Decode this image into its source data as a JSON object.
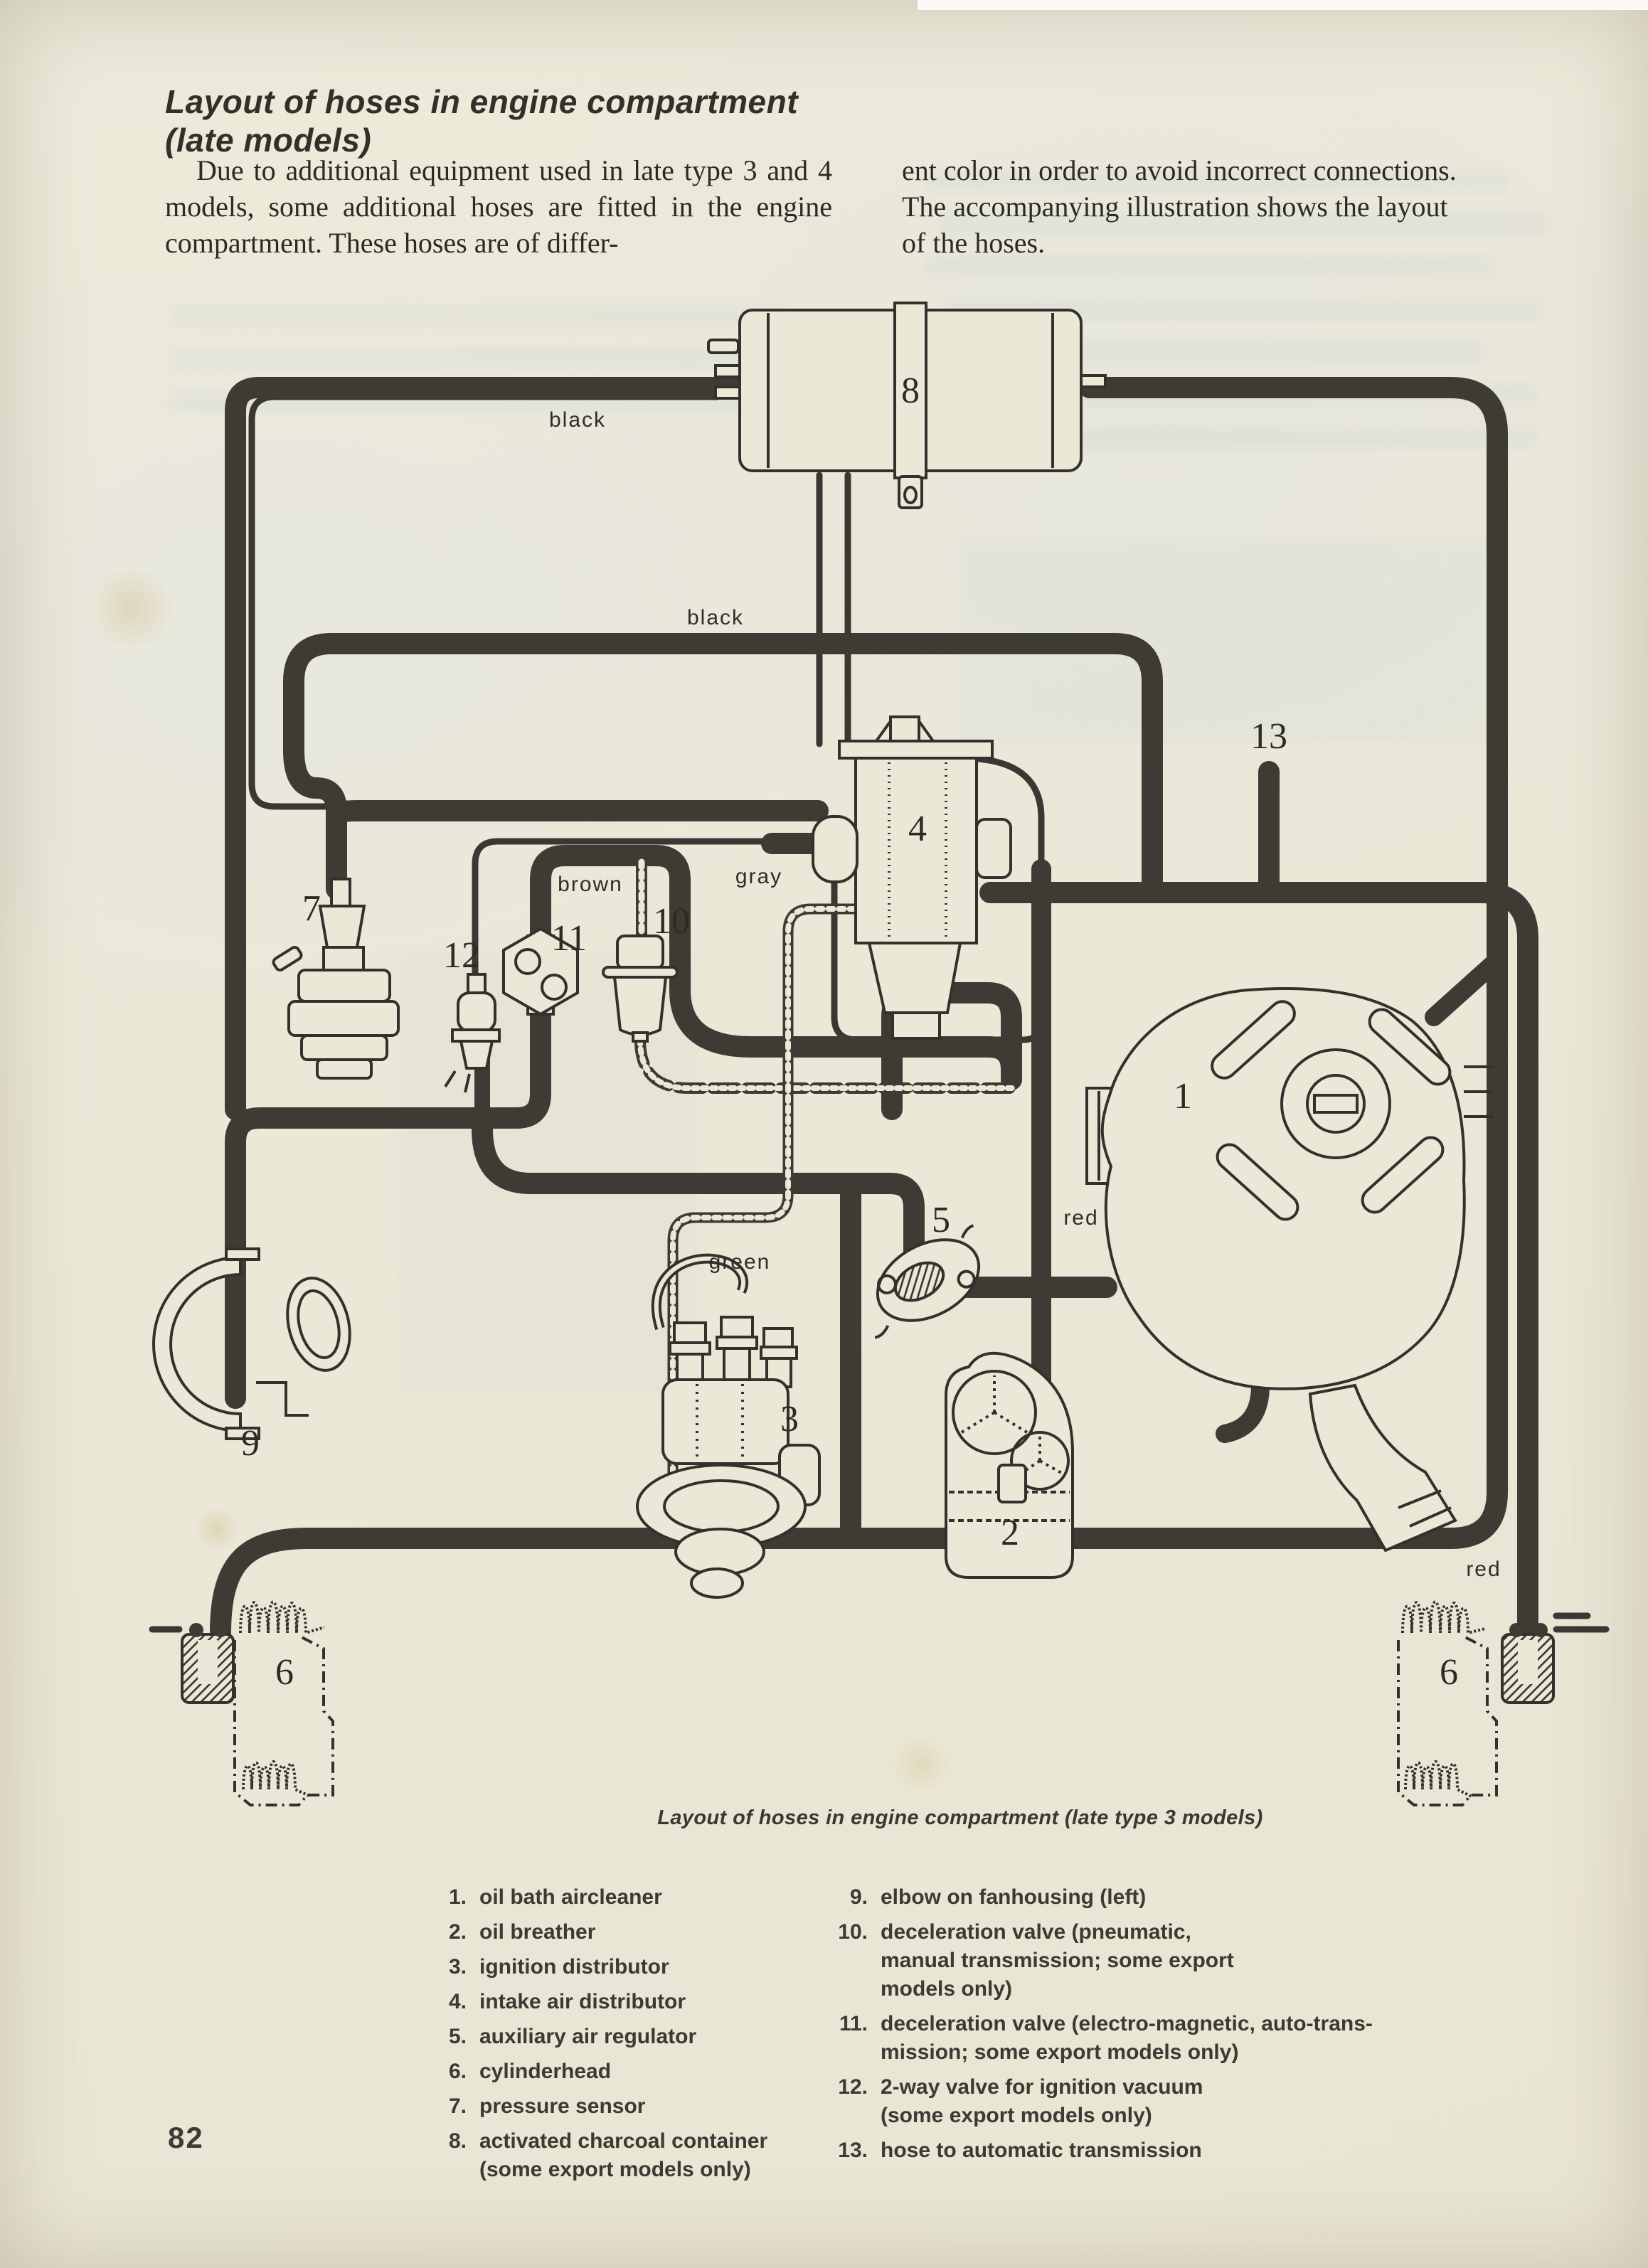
{
  "header": {
    "title_line1": "Layout of hoses in engine compartment",
    "title_line2": "(late models)"
  },
  "intro": {
    "left_column": "Due to additional equipment used in late type 3 and 4 models, some additional hoses are fitted in the engine compartment. These hoses are of differ-",
    "right_column": "ent color in order to avoid incorrect connections.\nThe accompanying illustration shows the layout\nof the hoses."
  },
  "figure": {
    "caption": "Layout of hoses in engine compartment (late type 3 models)",
    "hose_labels": {
      "black_top": "black",
      "black_mid": "black",
      "brown": "brown",
      "gray": "gray",
      "green": "green",
      "red_upper": "red",
      "red_lower": "red"
    },
    "callouts": {
      "c1": "1",
      "c2": "2",
      "c3": "3",
      "c4": "4",
      "c5": "5",
      "c6_left": "6",
      "c6_right": "6",
      "c7": "7",
      "c8": "8",
      "c9": "9",
      "c10": "10",
      "c11": "11",
      "c12": "12",
      "c13": "13"
    },
    "ink_color": "#3e3b35",
    "paper_color": "#ece8d8"
  },
  "legend": {
    "left": [
      {
        "num": "1.",
        "text": "oil bath aircleaner"
      },
      {
        "num": "2.",
        "text": "oil breather"
      },
      {
        "num": "3.",
        "text": "ignition distributor"
      },
      {
        "num": "4.",
        "text": "intake air distributor"
      },
      {
        "num": "5.",
        "text": "auxiliary air regulator"
      },
      {
        "num": "6.",
        "text": "cylinderhead"
      },
      {
        "num": "7.",
        "text": "pressure sensor"
      },
      {
        "num": "8.",
        "text": "activated charcoal container\n(some export models only)"
      }
    ],
    "right": [
      {
        "num": "9.",
        "text": "elbow on fanhousing (left)"
      },
      {
        "num": "10.",
        "text": "deceleration valve (pneumatic,\nmanual transmission; some export\nmodels only)"
      },
      {
        "num": "11.",
        "text": "deceleration valve (electro-magnetic, auto-trans-\nmission; some export models only)"
      },
      {
        "num": "12.",
        "text": "2-way valve for ignition vacuum\n(some export models only)"
      },
      {
        "num": "13.",
        "text": "hose to automatic transmission"
      }
    ]
  },
  "page": {
    "number": "82"
  }
}
